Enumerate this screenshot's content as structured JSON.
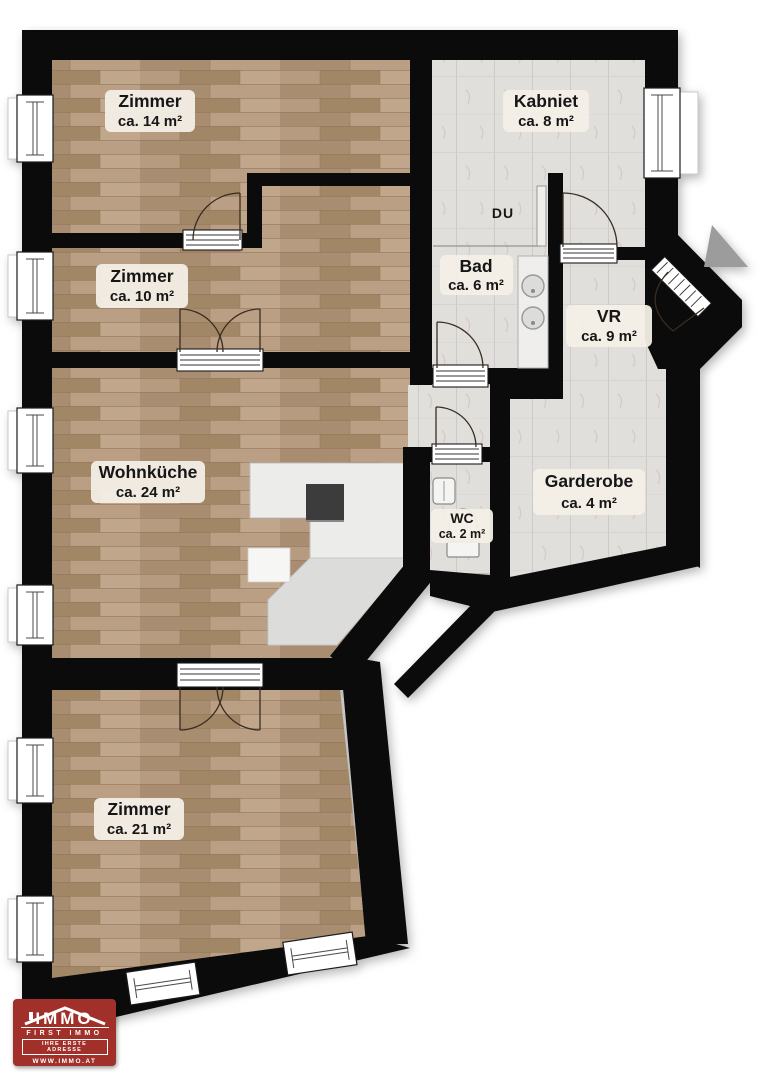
{
  "plan": {
    "type": "apartment-floor-plan",
    "rooms": [
      {
        "id": "zimmer14",
        "name": "Zimmer",
        "area": "ca. 14 m²"
      },
      {
        "id": "kabniet",
        "name": "Kabniet",
        "area": "ca. 8 m²"
      },
      {
        "id": "zimmer10",
        "name": "Zimmer",
        "area": "ca. 10 m²"
      },
      {
        "id": "du",
        "name": "DU",
        "area": ""
      },
      {
        "id": "bad",
        "name": "Bad",
        "area": "ca. 6 m²"
      },
      {
        "id": "vr",
        "name": "VR",
        "area": "ca. 9 m²"
      },
      {
        "id": "wohnkueche",
        "name": "Wohnküche",
        "area": "ca. 24 m²"
      },
      {
        "id": "wc",
        "name": "WC",
        "area": "ca. 2 m²"
      },
      {
        "id": "garderobe",
        "name": "Garderobe",
        "area": "ca. 4 m²"
      },
      {
        "id": "zimmer21",
        "name": "Zimmer",
        "area": "ca. 21 m²"
      }
    ]
  },
  "logo": {
    "brand": "IMMO",
    "subtitle": "FIRST IMMO",
    "tagline": "IHRE ERSTE ADRESSE",
    "website": "WWW.IMMO.AT",
    "background": "#a03029"
  },
  "colors": {
    "wall": "#0b0b0b",
    "wood_floor": "#b1967b",
    "tile_floor": "#e1dfdc",
    "kitchen_counter": "#ececea",
    "label_badge": "#f3eee6",
    "entrance_arrow": "#9c9c9c",
    "logo_red": "#a03029"
  }
}
